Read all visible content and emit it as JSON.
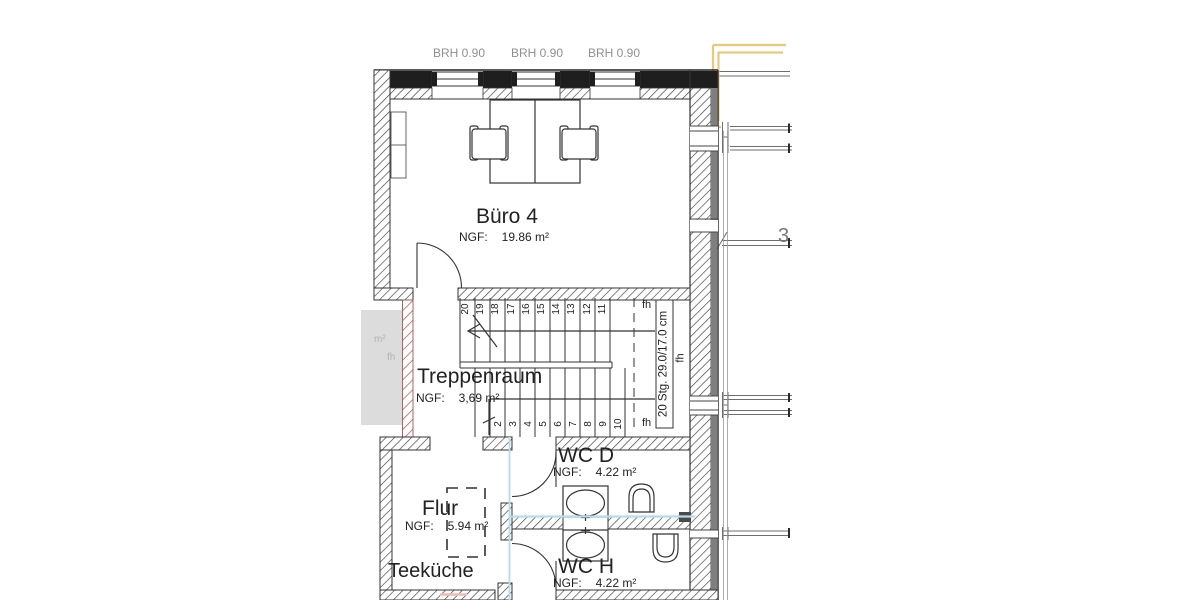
{
  "plan": {
    "window_labels": [
      {
        "text": "BRH 0.90"
      },
      {
        "text": "BRH 0.90"
      },
      {
        "text": "BRH 0.90"
      }
    ],
    "rooms": {
      "buero4": {
        "name": "Büro 4",
        "ngf_label": "NGF:",
        "area": "19.86 m²"
      },
      "treppenraum": {
        "name": "Treppenraum",
        "ngf_label": "NGF:",
        "area": "3,69 m²"
      },
      "wc_d": {
        "name": "WC D",
        "ngf_label": "NGF:",
        "area": "4.22 m²"
      },
      "wc_h": {
        "name": "WC H",
        "ngf_label": "NGF:",
        "area": "4.22 m²"
      },
      "flur": {
        "name": "Flur",
        "ngf_label": "NGF:",
        "area": "5.94 m²"
      },
      "teekueche": {
        "name": "Teeküche"
      }
    },
    "adjacent_room": {
      "area_fragment": "m²",
      "fh": "fh"
    },
    "stairs": {
      "spec": "20 Stg. 29.0/17.0 cm",
      "top_run": [
        "20",
        "19",
        "18",
        "17",
        "16",
        "15",
        "14",
        "13",
        "12",
        "11"
      ],
      "bottom_run": [
        "2",
        "3",
        "4",
        "5",
        "6",
        "7",
        "8",
        "9",
        "10"
      ],
      "fh_top": "fh",
      "fh_mid": "fh",
      "fh_bottom": "fh"
    },
    "annotations": {
      "grid_label": "3"
    },
    "colors": {
      "markup_yellow": "#ecc87d",
      "pipe_cyan": "#b5dcea",
      "hatch_red": "#c06060",
      "wall_dark": "#1e1e1e"
    }
  }
}
